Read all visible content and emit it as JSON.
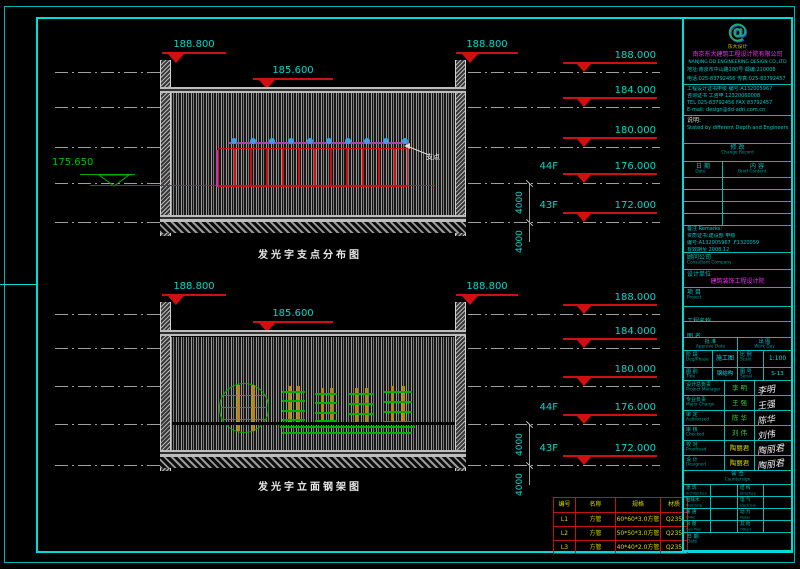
{
  "colors": {
    "border_cyan": "#00dcdc",
    "elevation_teal": "#00d8c8",
    "marker_red": "#d01010",
    "datum_green": "#00b000",
    "support_magenta": "#b040b0",
    "support_dot_blue": "#3aa0e8",
    "frame_green": "#00b000",
    "frame_orange": "#b8860b",
    "table_yellow": "#d8d800"
  },
  "drawing1": {
    "caption": "发光字支点分布图",
    "marker_left": "188.800",
    "marker_right": "188.800",
    "marker_mid": "185.600",
    "left_datum": "175.650",
    "leader_note": "支点",
    "support_count": 10,
    "dim": "4000",
    "levels": [
      {
        "floor": "",
        "elev": "188.000"
      },
      {
        "floor": "",
        "elev": "184.000"
      },
      {
        "floor": "",
        "elev": "180.000"
      },
      {
        "floor": "44F",
        "elev": "176.000"
      },
      {
        "floor": "43F",
        "elev": "172.000"
      }
    ]
  },
  "drawing2": {
    "caption": "发光字立面钢架图",
    "marker_left": "188.800",
    "marker_right": "188.800",
    "marker_mid": "185.600",
    "dim": "4000",
    "levels": [
      {
        "floor": "",
        "elev": "188.000"
      },
      {
        "floor": "",
        "elev": "184.000"
      },
      {
        "floor": "",
        "elev": "180.000"
      },
      {
        "floor": "44F",
        "elev": "176.000"
      },
      {
        "floor": "43F",
        "elev": "172.000"
      }
    ]
  },
  "materials_table": {
    "title": "构件表",
    "headers": [
      "编号",
      "名称",
      "规格",
      "材质"
    ],
    "rows": [
      [
        "L1",
        "方管",
        "60*60*3.0方管",
        "Q235"
      ],
      [
        "L2",
        "方管",
        "50*50*3.0方管",
        "Q235"
      ],
      [
        "L3",
        "方管",
        "40*40*2.0方管",
        "Q235"
      ]
    ]
  },
  "titleblock": {
    "logo_glyph": "@",
    "logo_caption": "东大设计",
    "company_cn": "南京东大建筑工程设计院有限公司",
    "company_en": "NANJING DD ENGINEERING DESIGN CO.,LTD",
    "addr_line1": "地址:南京市中山路100号  邮编:210008",
    "addr_line2": "电话:025-83792456  传真:025-83792457",
    "cert_lines": [
      "工程设计证书甲级 编号:A132005967",
      "咨询证书 工咨甲 12320060008",
      "TEL 025-83792456  FAX 83792457",
      "E-mail: design@dd-adri.com.cn"
    ],
    "note_label": "说明:",
    "note_text": "Stated by different Depth and Engineers",
    "change_header_cn": "修 改",
    "change_header_en": "Change Record",
    "change_col_date_cn": "日 期",
    "change_col_date_en": "Date",
    "change_col_content_cn": "内 容",
    "change_col_content_en": "Brief Content",
    "remarks_label": "备注 Remarks:",
    "remarks_lines": [
      "资质证书:建设部 甲级",
      "编号:A132005967 ,F1320059",
      "有效期至 2008.12"
    ],
    "consultant_label_cn": "顾问公司",
    "consultant_label_en": "Consultant Company",
    "designer_label_cn": "设计单位",
    "designer_label_en": "Designer",
    "designer_value": "建筑装饰工程设计院",
    "project_label_cn": "项 目",
    "project_label_en": "Project",
    "drgname_label_cn": "工程名称",
    "drgname_label_en": "Drg Name",
    "drgname_value": "紫峰大厦,南京",
    "drgtitle_label_cn": "图 名",
    "drgtitle_label_en": "Drg Title",
    "drgtitle_value": "C2-13",
    "approve_label_cn": "批 准",
    "approve_label_en": "Approve Date",
    "workday_label_cn": "出 图",
    "workday_label_en": "Work Day",
    "phase_label_cn": "阶 段",
    "phase_label_en": "Deg/Phase",
    "phase_value": "施工图",
    "scale_label_cn": "比 例",
    "scale_label_en": "Scale",
    "scale_value": "1:100",
    "type_label_cn": "图 别",
    "type_label_en": "Title",
    "type_value": "钢结构",
    "serial_label_cn": "图 号",
    "serial_label_en": "Serial",
    "serial_value": "S-13",
    "sign_rows": [
      {
        "cn": "设计总负责",
        "en": "Project Manager",
        "value": "李 明",
        "color": "green",
        "sig": "李明"
      },
      {
        "cn": "专业负责",
        "en": "Major Charge",
        "value": "王 强",
        "color": "green",
        "sig": "王强"
      },
      {
        "cn": "审 定",
        "en": "Authorized",
        "value": "陈 华",
        "color": "green",
        "sig": "陈华"
      },
      {
        "cn": "审 核",
        "en": "Checked",
        "value": "刘 伟",
        "color": "green",
        "sig": "刘伟"
      },
      {
        "cn": "校 对",
        "en": "Proofread",
        "value": "陶丽君",
        "color": "yellow",
        "sig": "陶丽君"
      },
      {
        "cn": "设 计",
        "en": "Designed",
        "value": "陶丽君",
        "color": "yellow",
        "sig": "陶丽君"
      }
    ],
    "countersign_header_cn": "会 签",
    "countersign_header_en": "Countersign",
    "countersign_rows": [
      [
        "建 筑",
        "Architecture",
        "结 构",
        "Structure"
      ],
      [
        "给排水",
        "Plumbing",
        "电 气",
        "Electrical"
      ],
      [
        "暖 通",
        "HVAC",
        "动 力",
        "Power"
      ],
      [
        "总 图",
        "Gen Plan",
        "其 他",
        "Others"
      ]
    ],
    "date_label_cn": "日 期",
    "date_label_en": "Date"
  }
}
